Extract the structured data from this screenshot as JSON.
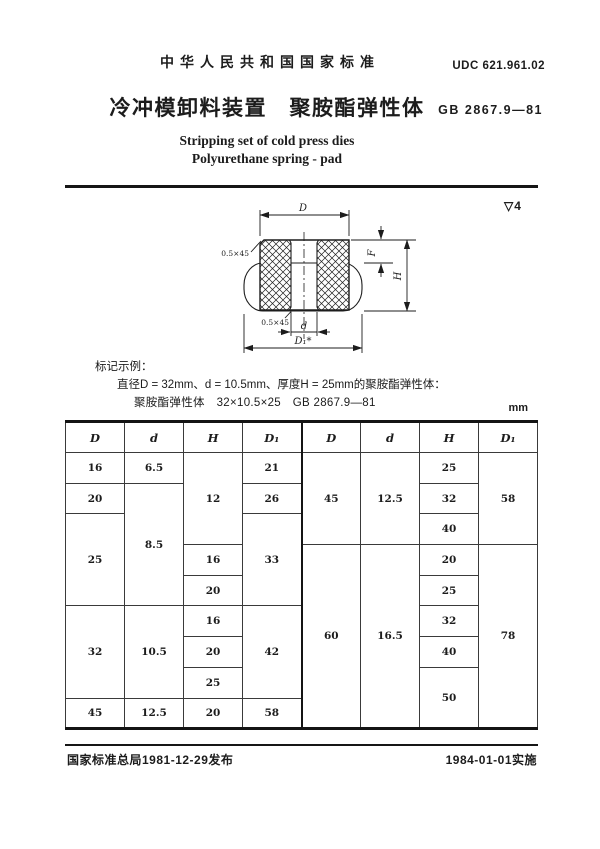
{
  "header": {
    "national_standard": "中华人民共和国国家标准",
    "udc": "UDC 621.961.02",
    "title_cn": "冷冲模卸料装置　聚胺酯弹性体",
    "standard_code": "GB 2867.9—81",
    "title_en_1": "Stripping set of cold press dies",
    "title_en_2": "Polyurethane spring - pad"
  },
  "drawing": {
    "surface_roughness": "▽4",
    "dim_D": "D",
    "dim_d": "d",
    "dim_D1": "D₁*",
    "dim_H": "H",
    "dim_F": "F",
    "chamfer_top": "0.5×45",
    "chamfer_bottom": "0.5×45"
  },
  "example": {
    "heading": "标记示例：",
    "description": "直径D = 32mm、d = 10.5mm、厚度H = 25mm的聚胺酯弹性体：",
    "designation": "聚胺酯弹性体　32×10.5×25　GB 2867.9—81"
  },
  "table": {
    "unit": "mm",
    "headers": [
      "D",
      "d",
      "H",
      "D₁",
      "D",
      "d",
      "H",
      "D₁"
    ],
    "left": {
      "D": [
        "16",
        "20",
        "25",
        "32",
        "45"
      ],
      "d": [
        "6.5",
        "8.5",
        "10.5",
        "12.5"
      ],
      "H": [
        "12",
        "16",
        "20",
        "16",
        "20",
        "25",
        "20"
      ],
      "D1": [
        "21",
        "26",
        "33",
        "42",
        "58"
      ]
    },
    "right": {
      "D": [
        "45",
        "60"
      ],
      "d": [
        "12.5",
        "16.5"
      ],
      "H": [
        "25",
        "32",
        "40",
        "20",
        "25",
        "32",
        "40",
        "50"
      ],
      "D1": [
        "58",
        "78"
      ]
    }
  },
  "footer": {
    "issued": "国家标准总局1981-12-29发布",
    "effective": "1984-01-01实施"
  },
  "colors": {
    "ink": "#1c1c1c",
    "paper": "#ffffff"
  }
}
